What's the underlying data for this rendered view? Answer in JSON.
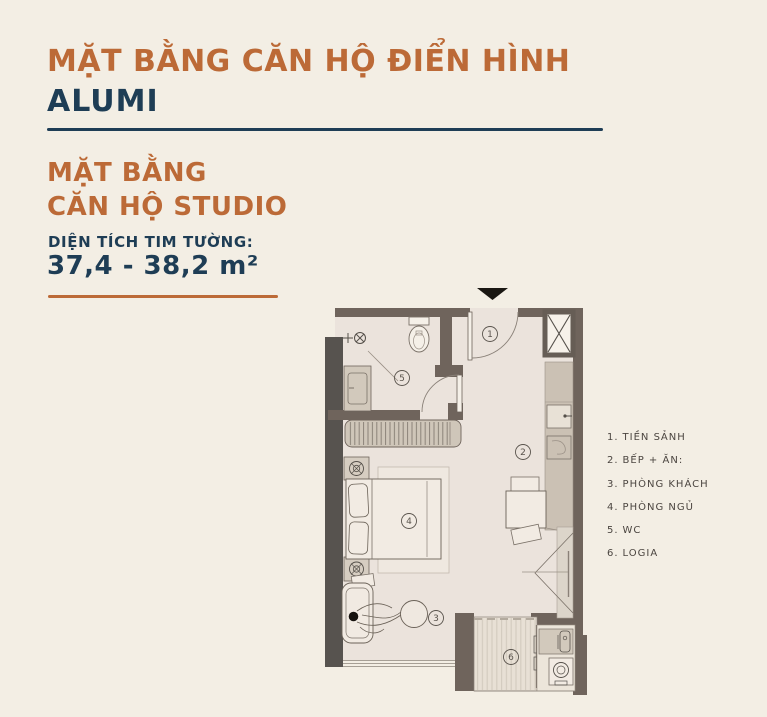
{
  "header": {
    "title_line1": "MẶT BẰNG CĂN HỘ ĐIỂN HÌNH",
    "title_line2": "ALUMI"
  },
  "unit": {
    "subtitle_line1": "MẶT BẰNG",
    "subtitle_line2": "CĂN HỘ STUDIO",
    "area_label": "DIỆN TÍCH TIM TƯỜNG:",
    "area_value": "37,4 - 38,2 m²"
  },
  "legend": {
    "items": [
      {
        "num": "1.",
        "label": "TIỀN SẢNH"
      },
      {
        "num": "2.",
        "label": "BẾP + ĂN:"
      },
      {
        "num": "3.",
        "label": "PHÒNG KHÁCH"
      },
      {
        "num": "4.",
        "label": "PHÒNG NGỦ"
      },
      {
        "num": "5.",
        "label": "WC"
      },
      {
        "num": "6.",
        "label": "LOGIA"
      }
    ]
  },
  "plan": {
    "rooms": [
      {
        "num": "1"
      },
      {
        "num": "2"
      },
      {
        "num": "3"
      },
      {
        "num": "4"
      },
      {
        "num": "5"
      },
      {
        "num": "6"
      }
    ]
  },
  "colors": {
    "accent_orange": "#bc6a37",
    "navy": "#1e3d55",
    "background": "#f3eee4",
    "wall": "#6f645c",
    "wall_dark": "#57534f",
    "floor": "#ebe3dc",
    "counter": "#cbc1b4"
  }
}
